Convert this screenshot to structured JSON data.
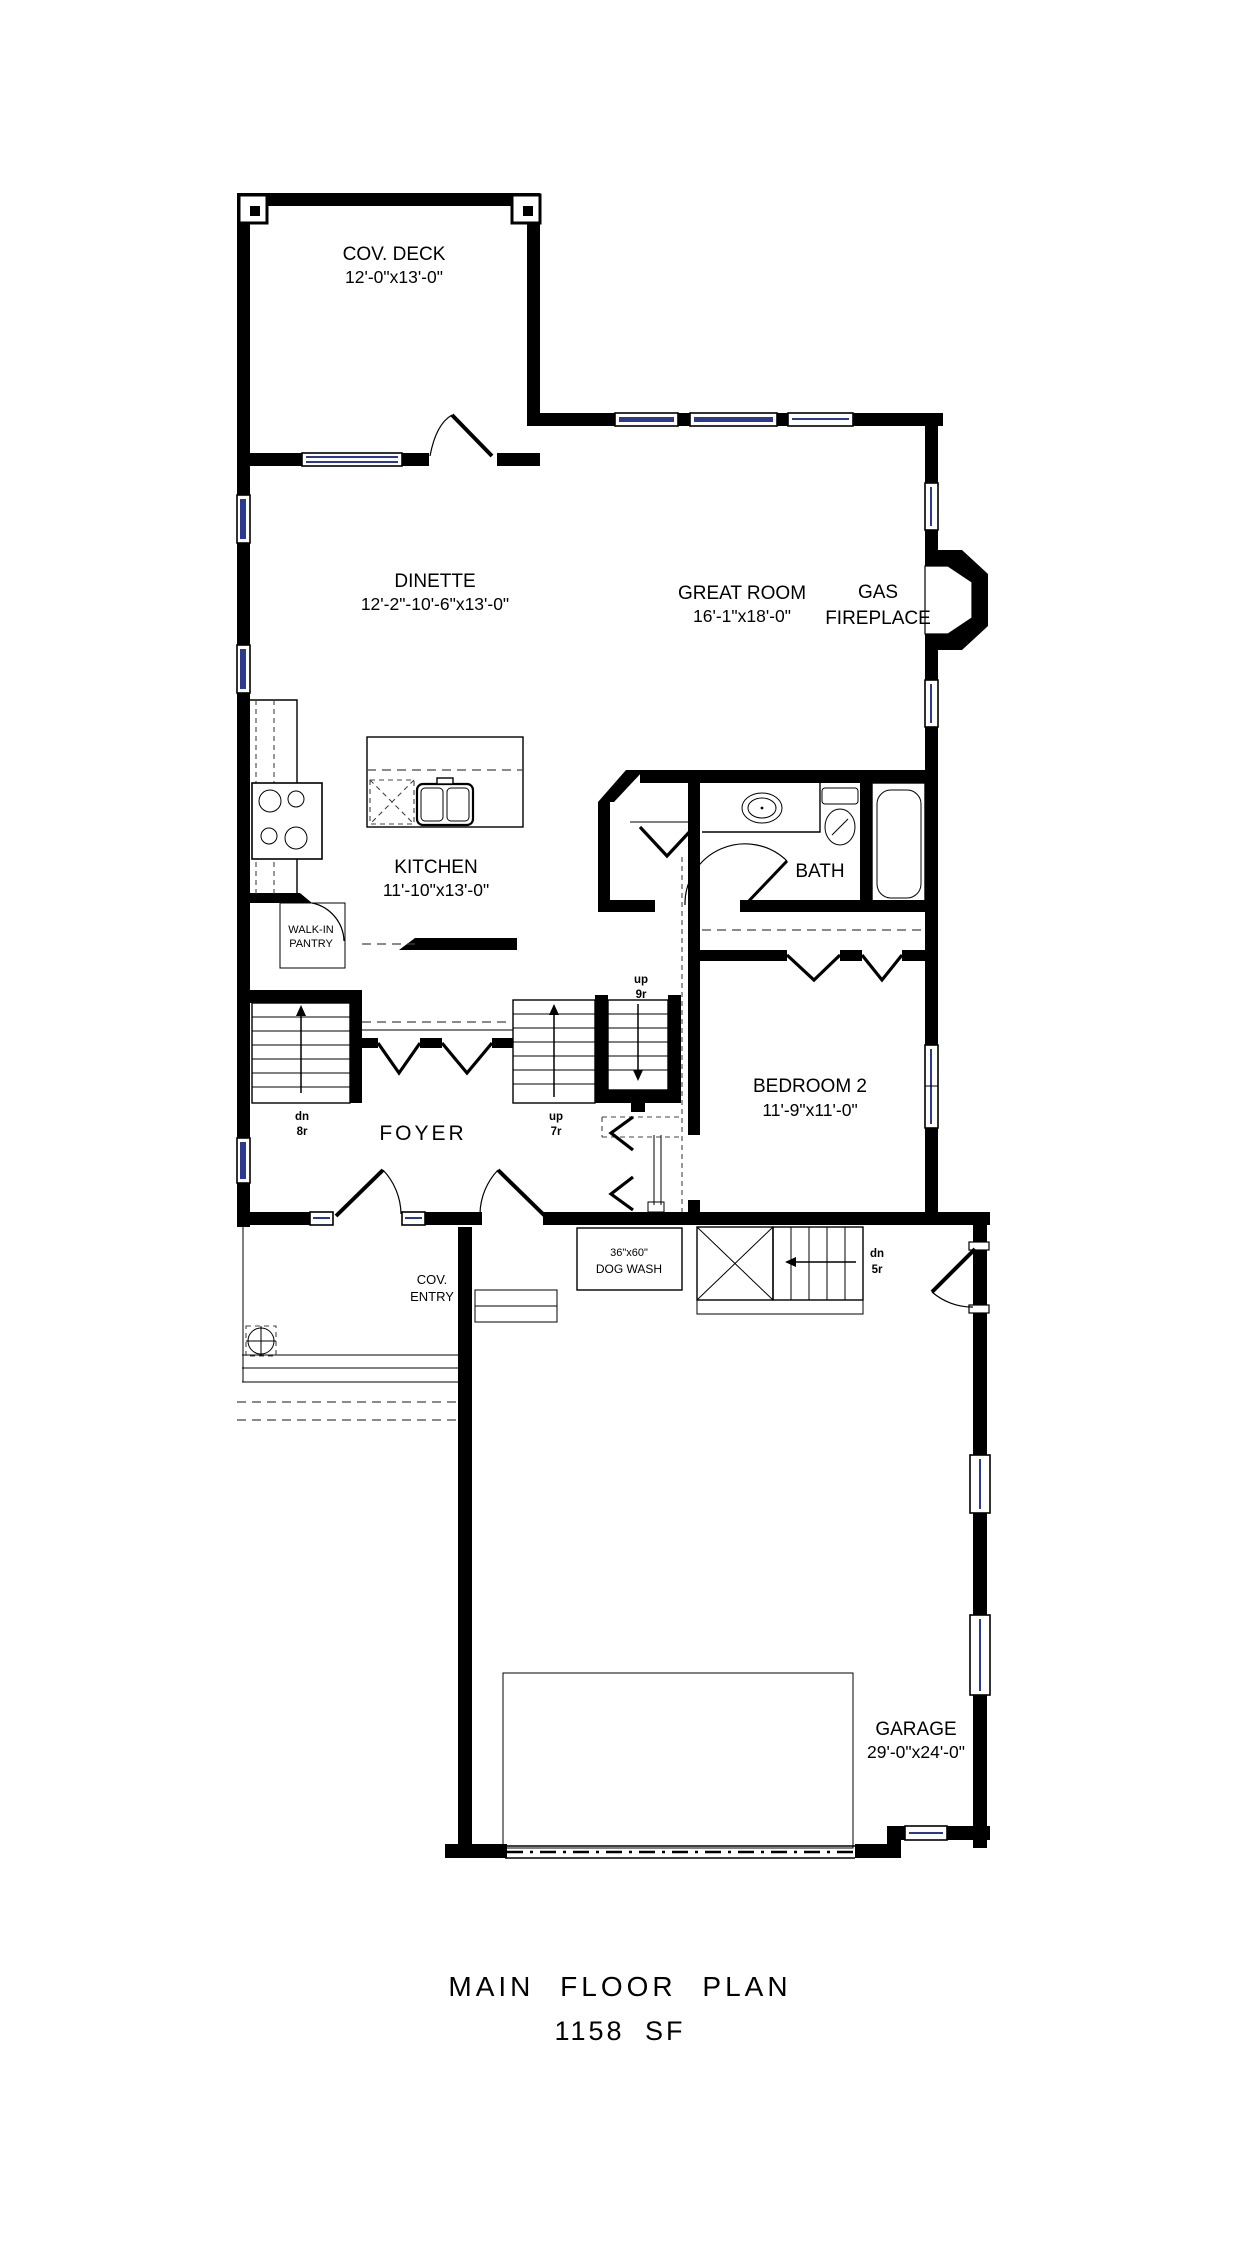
{
  "title": {
    "line1": "MAIN FLOOR PLAN",
    "line2": "1158 SF"
  },
  "rooms": {
    "cov_deck": {
      "name": "COV. DECK",
      "dims": "12'-0\"x13'-0\""
    },
    "dinette": {
      "name": "DINETTE",
      "dims": "12'-2\"-10'-6\"x13'-0\""
    },
    "great_room": {
      "name": "GREAT ROOM",
      "dims": "16'-1\"x18'-0\""
    },
    "fireplace": {
      "line1": "GAS",
      "line2": "FIREPLACE"
    },
    "kitchen": {
      "name": "KITCHEN",
      "dims": "11'-10\"x13'-0\""
    },
    "pantry": {
      "line1": "WALK-IN",
      "line2": "PANTRY"
    },
    "bath": {
      "name": "BATH"
    },
    "bedroom2": {
      "name": "BEDROOM 2",
      "dims": "11'-9\"x11'-0\""
    },
    "foyer": {
      "name": "FOYER"
    },
    "cov_entry": {
      "line1": "COV.",
      "line2": "ENTRY"
    },
    "dog_wash": {
      "size": "36\"x60\"",
      "name": "DOG WASH"
    },
    "garage": {
      "name": "GARAGE",
      "dims": "29'-0\"x24'-0\""
    }
  },
  "stairs": {
    "dn8r": {
      "line1": "dn",
      "line2": "8r"
    },
    "up7r": {
      "line1": "up",
      "line2": "7r"
    },
    "up9r": {
      "line1": "up",
      "line2": "9r"
    },
    "dn5r": {
      "line1": "dn",
      "line2": "5r"
    }
  },
  "colors": {
    "wall": "#000000",
    "window_glass": "#2b3990",
    "background": "#ffffff"
  }
}
